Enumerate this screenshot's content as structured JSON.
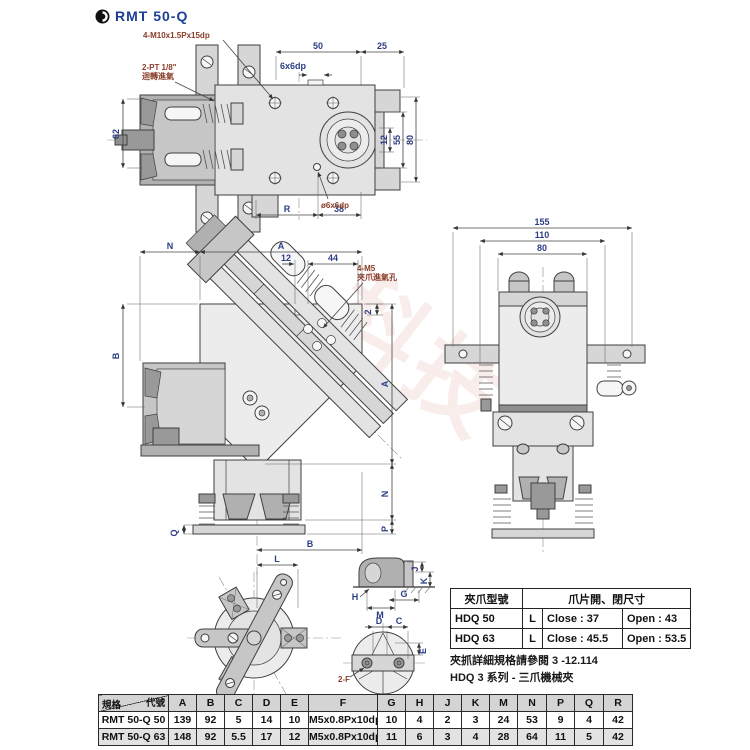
{
  "header": {
    "title": "RMT 50-Q"
  },
  "watermark": "科技",
  "top_view": {
    "callouts": {
      "bolts": "4-M10x1.5Px15dp",
      "port1": "2-PT 1/8\"",
      "port2": "迴轉進氣",
      "slot": "6x6dp",
      "hole": "ø6x6dp"
    },
    "dims": {
      "w1": "50",
      "w2": "25",
      "right1": "12",
      "right2": "55",
      "right3": "80",
      "left": "62",
      "bottom1": "R",
      "bottom2": "38"
    }
  },
  "angled_view": {
    "callouts": {
      "m5": "4-M5",
      "m5sub": "夾爪進氣孔"
    },
    "dims": {
      "top_n": "N",
      "top_a": "A",
      "s12": "12",
      "s44": "44",
      "s2": "2",
      "left_b": "B",
      "right_a": "A",
      "right_n": "N",
      "right_p": "P",
      "q": "Q",
      "bottom_b": "B"
    }
  },
  "side_view": {
    "dims": {
      "w155": "155",
      "w110": "110",
      "w80": "80"
    }
  },
  "chuck_view": {
    "dims": {
      "l": "L"
    }
  },
  "detail_top": {
    "dims": {
      "j": "J",
      "k": "K",
      "g": "G",
      "h": "H",
      "m": "M"
    }
  },
  "detail_bottom": {
    "dims": {
      "d": "D",
      "c": "C",
      "e": "E"
    },
    "callout": "2-F"
  },
  "jaw_table": {
    "header": {
      "model": "夾爪型號",
      "size": "爪片開、閉尺寸"
    },
    "rows": [
      {
        "model": "HDQ 50",
        "type": "L",
        "close": "Close : 37",
        "open": "Open : 43"
      },
      {
        "model": "HDQ 63",
        "type": "L",
        "close": "Close : 45.5",
        "open": "Open : 53.5"
      }
    ]
  },
  "notes": [
    "夾抓詳細規格請參閱 3 -12.114",
    "HDQ 3 系列 - 三爪機械夾"
  ],
  "spec_table": {
    "corner": {
      "top": "代號",
      "bottom": "規格"
    },
    "columns": [
      "A",
      "B",
      "C",
      "D",
      "E",
      "F",
      "G",
      "H",
      "J",
      "K",
      "M",
      "N",
      "P",
      "Q",
      "R"
    ],
    "rows": [
      {
        "model": "RMT 50-Q 50",
        "values": [
          "139",
          "92",
          "5",
          "14",
          "10",
          "M5x0.8Px10dp",
          "10",
          "4",
          "2",
          "3",
          "24",
          "53",
          "9",
          "4",
          "42"
        ]
      },
      {
        "model": "RMT 50-Q 63",
        "values": [
          "148",
          "92",
          "5.5",
          "17",
          "12",
          "M5x0.8Px10dp",
          "11",
          "6",
          "3",
          "4",
          "28",
          "64",
          "11",
          "5",
          "42"
        ]
      }
    ]
  }
}
